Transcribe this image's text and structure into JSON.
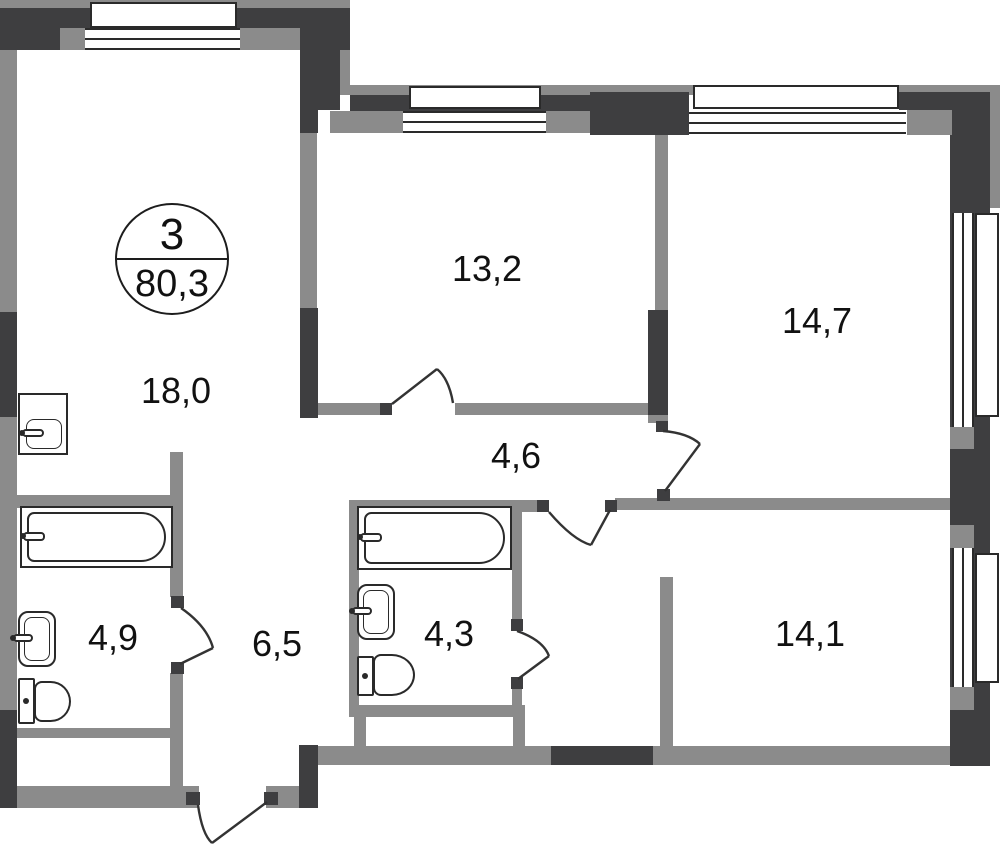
{
  "floor_plan": {
    "badge": {
      "rooms": "3",
      "area": "80,3"
    },
    "rooms": {
      "r18": {
        "label": "18,0"
      },
      "r13": {
        "label": "13,2"
      },
      "r147": {
        "label": "14,7"
      },
      "h46": {
        "label": "4,6"
      },
      "b49": {
        "label": "4,9"
      },
      "h65": {
        "label": "6,5"
      },
      "b43": {
        "label": "4,3"
      },
      "r141": {
        "label": "14,1"
      }
    },
    "colors": {
      "wall_dark": "#3e3e40",
      "wall_gray": "#8b8b8b",
      "outline": "#2a2a2a",
      "door_line": "#333333",
      "text": "#111111",
      "background": "#ffffff"
    }
  }
}
